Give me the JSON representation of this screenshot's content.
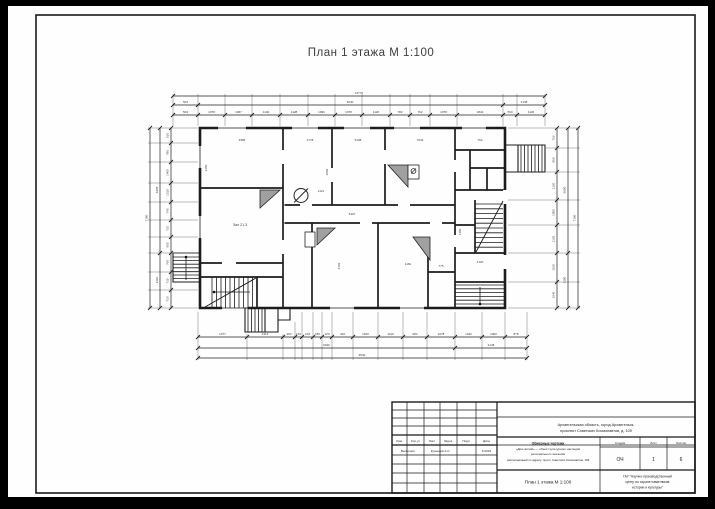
{
  "colors": {
    "background": "#000000",
    "sheet": "#fefefe",
    "ink": "#1c1c1c",
    "stove_fill": "#a0a0a0"
  },
  "drawing_title": "План 1 этажа М 1:100",
  "plan": {
    "room_label": "Зал 21.3",
    "labels": [
      "4985",
      "2778",
      "5108",
      "7642",
      "762",
      "2150",
      "3560",
      "1121",
      "5407",
      "6102",
      "1181",
      "775",
      "1450",
      "2120"
    ]
  },
  "dims": {
    "top_overall": "13770",
    "top_mid": [
      "504",
      "9240",
      "2148"
    ],
    "top_detail": [
      "504",
      "1078",
      "1067",
      "1140",
      "1128",
      "1090",
      "1078",
      "1120",
      "782",
      "762",
      "1078",
      "1842",
      "560",
      "1120"
    ],
    "left_overall": "7180",
    "left_mid": [
      "4965",
      "2110"
    ],
    "left_detail": [
      "610",
      "780",
      "1400",
      "1510",
      "745",
      "715",
      "655",
      "760",
      "730",
      "720"
    ],
    "bottom_detail": [
      "1077",
      "1313",
      "250",
      "140",
      "218",
      "180",
      "120",
      "440",
      "1020",
      "1140",
      "984",
      "1078",
      "1342",
      "1000",
      "878"
    ],
    "bottom_mid": [
      "9040",
      "2148"
    ],
    "bottom_overall": "9540",
    "right_detail": [
      "762",
      "950",
      "1120",
      "1000",
      "1128",
      "1160",
      "1040"
    ],
    "right_mid": [
      "5000",
      "2180"
    ],
    "right_overall": "7180"
  },
  "title_block": {
    "rev_headers": [
      "Изм.",
      "Кол.уч",
      "Лист",
      "№док.",
      "Подп.",
      "Дата"
    ],
    "row_role": "Выполнил",
    "row_name": "Кузнецов А.С.",
    "row_date": "6.2023",
    "address_line1": "Архангельская область, город Архангельск,",
    "address_line2": "проспект Советских Космонавтов, д. 109",
    "doc_line1": "Обмерные чертежи",
    "doc_line2": "«Дом жилой» — объект культурного наследия",
    "doc_line3": "регионального значения",
    "doc_line4": "расположенный по адресу: просп. Советских Космонавтов, 109",
    "stage_header": "Стадия",
    "sheet_header": "Лист",
    "sheets_header": "Листов",
    "stage": "ОЧ",
    "sheet": "1",
    "sheets": "6",
    "sheet_title": "План 1 этажа М 1:100",
    "org_line1": "ГАУ \"Научно-производственный",
    "org_line2": "центр по охране памятников",
    "org_line3": "истории и культуры\""
  }
}
